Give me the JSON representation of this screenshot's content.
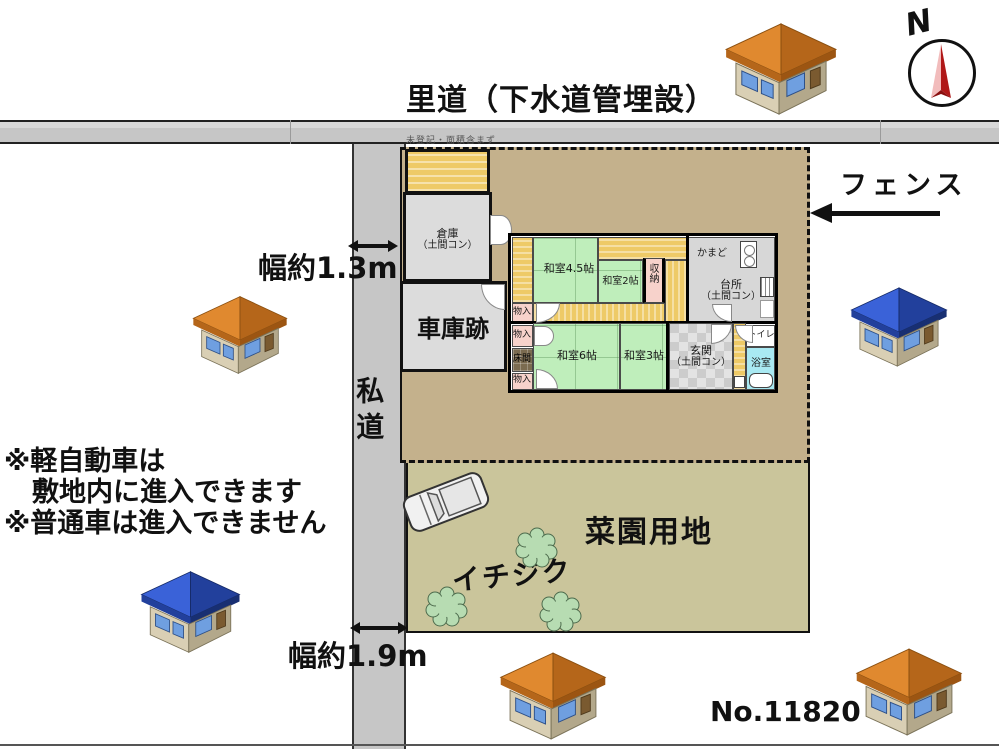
{
  "colors": {
    "road": "#c6c6c6",
    "plot": "#c4b18c",
    "garden": "#cac59b",
    "tatami": "#bfeebb",
    "engawa": "#eeca67",
    "closet_pink": "#f7d2cb",
    "doma": "#d7d7d7",
    "bath": "#a9e9f2",
    "tokonoma": "#7b6b50",
    "tree_green": "#b7dcb2",
    "roof_orange_light": "#e0892f",
    "roof_orange_dark": "#b5661a",
    "roof_blue_light": "#3a62d8",
    "roof_blue_dark": "#22409c",
    "wall_light": "#d9cfb4",
    "wall_dark": "#b3a88b",
    "window_blue": "#6f9fe0",
    "needle_dark": "#b01818",
    "needle_light": "#f2bcbc"
  },
  "top_road": {
    "label": "里道（下水道管埋設）"
  },
  "compass": {
    "label": "N"
  },
  "fence": {
    "label": "フェンス"
  },
  "side_road": {
    "label": "私道",
    "width_top": "幅約1.3m",
    "width_bottom": "幅約1.9m"
  },
  "plot": {
    "tiny_note": "未登記・面積含まず"
  },
  "buildings": {
    "storage": {
      "line1": "倉庫",
      "line2": "（土間コン）"
    },
    "garage": {
      "label": "車庫跡"
    }
  },
  "house": {
    "washitsu45": "和室4.5帖",
    "washitsu2": "和室2帖",
    "shuno": "収納",
    "kamado": "かまど",
    "kitchen1": "台所",
    "kitchen2": "（土間コン）",
    "monoire_a": "物入",
    "monoire_b": "物入",
    "monoire_c": "物入",
    "tokonoma": "床間",
    "washitsu6": "和室6帖",
    "washitsu3": "和室3帖",
    "genkan1": "玄関",
    "genkan2": "（土間コン）",
    "toilet": "トイレ",
    "bath": "浴室"
  },
  "garden": {
    "label": "菜園用地",
    "fig": "イチジク"
  },
  "notes": {
    "line1": "※軽自動車は",
    "line2": "敷地内に進入できます",
    "line3": "※普通車は進入できません"
  },
  "ref_no": "No.11820"
}
